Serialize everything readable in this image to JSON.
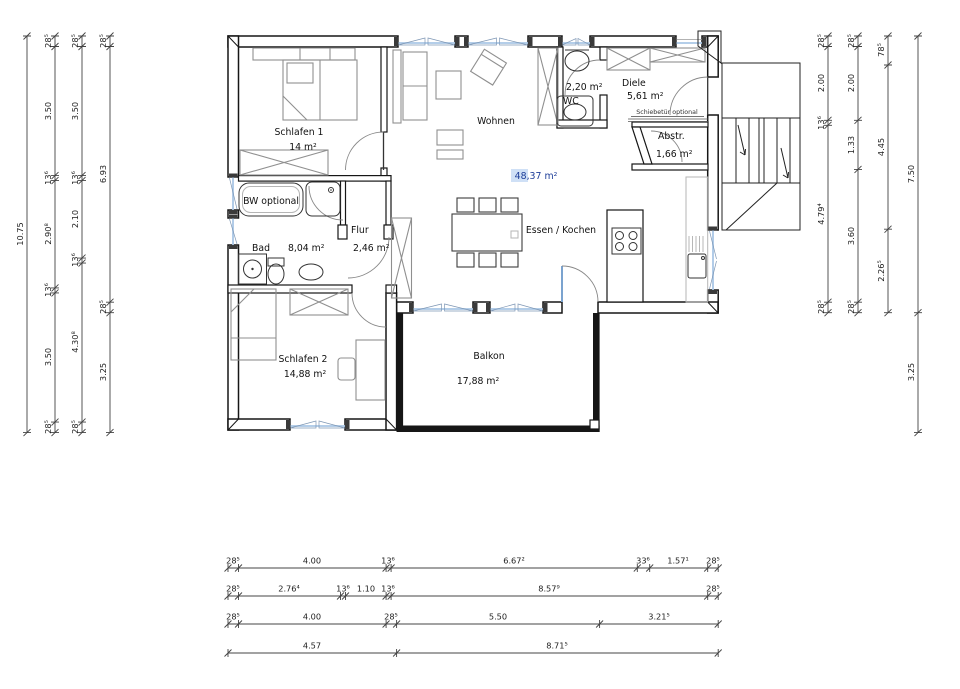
{
  "plan": {
    "rooms": {
      "schlafen1": {
        "name": "Schlafen 1",
        "area": "14 m²"
      },
      "wohnen": {
        "name": "Wohnen"
      },
      "wc": {
        "name": "WC",
        "area": "2,20 m²"
      },
      "diele": {
        "name": "Diele",
        "area": "5,61 m²"
      },
      "abstellraum": {
        "name": "Abstr.",
        "area": "1,66 m²"
      },
      "bad": {
        "name": "Bad",
        "area": "8,04 m²"
      },
      "flur": {
        "name": "Flur",
        "area": "2,46 m²"
      },
      "essen_kochen": {
        "name": "Essen / Kochen"
      },
      "schlafen2": {
        "name": "Schlafen 2",
        "area": "14,88 m²"
      },
      "balkon": {
        "name": "Balkon",
        "area": "17,88 m²"
      }
    },
    "annotations": {
      "total_area": "48,37 m²",
      "bw_optional": "BW optional",
      "schiebetuer": "Schiebetür optional"
    },
    "colors": {
      "window_glass": "#a9c7e6",
      "area_highlight": "#cfe0f6",
      "area_text": "#1e3e99"
    }
  },
  "dims": {
    "left": {
      "total": [
        "10.75"
      ],
      "c2": [
        "28⁵",
        "3.50",
        "13⁶",
        "2.90⁸",
        "13⁶",
        "3.50",
        "28⁵"
      ],
      "c3": [
        "28⁵",
        "3.50",
        "13⁶",
        "2.10",
        "13⁶",
        "4.30⁸",
        "28⁵"
      ],
      "c4": [
        "28⁵",
        "6.93",
        "28⁵",
        "3.25"
      ]
    },
    "right": {
      "c1": [
        "28⁵",
        "2.00",
        "13⁶",
        "4.79⁴",
        "28⁵"
      ],
      "c2": [
        "28⁵",
        "2.00",
        "1.33",
        "3.60",
        "28⁵"
      ],
      "c3": [
        "78⁵",
        "4.45",
        "2.26⁵"
      ],
      "c4": [
        "7.50",
        "3.25"
      ]
    },
    "bottom": {
      "r1": [
        "28⁵",
        "4.00",
        "13⁶",
        "6.67²",
        "33⁶",
        "1.57¹",
        "28⁵"
      ],
      "r2": [
        "28⁵",
        "2.76⁴",
        "13⁶",
        "1.10",
        "13⁶",
        "8.57⁹",
        "28⁵"
      ],
      "r3": [
        "28⁵",
        "4.00",
        "28⁵",
        "5.50",
        "3.21⁵"
      ],
      "r4": [
        "4.57",
        "8.71⁵"
      ]
    }
  }
}
